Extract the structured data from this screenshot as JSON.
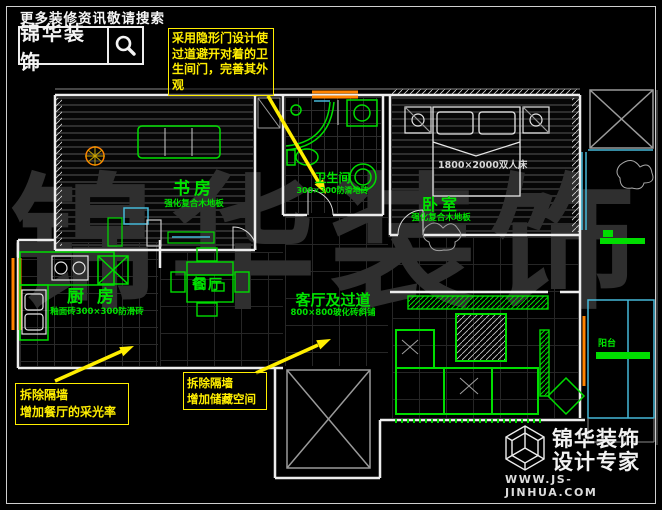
{
  "header": {
    "search_hint": "更多装修资讯敬请搜索",
    "brand": "锦华装饰",
    "search_icon": "magnifier-icon"
  },
  "callouts": {
    "hidden_door": {
      "text": "采用隐形门设计使过道避开对着的卫生间门，完善其外观"
    },
    "dining_light": {
      "line1": "拆除隔墙",
      "line2": "增加餐厅的采光率"
    },
    "storage": {
      "line1": "拆除隔墙",
      "line2": "增加储藏空间"
    }
  },
  "rooms": {
    "study": {
      "name": "书房",
      "floor": "强化复合木地板"
    },
    "bath": {
      "name": "卫生间",
      "floor": "300×300防滑地砖"
    },
    "bedroom": {
      "name": "卧室",
      "floor": "强化复合木地板"
    },
    "kitchen": {
      "name": "厨房",
      "floor": "釉面砖300×300防滑砖"
    },
    "dining": {
      "name": "餐厅"
    },
    "living": {
      "name": "客厅及过道",
      "floor": "800×800玻化砖斜铺"
    },
    "balcony": {
      "name": "阳台"
    }
  },
  "furniture": {
    "bed_label": "1800×2000双人床"
  },
  "watermark": {
    "text": "锦华装饰"
  },
  "footer": {
    "logo_icon": "cube-logo-icon",
    "brand_line1": "锦华装饰",
    "brand_line2": "设计专家",
    "website": "WWW.JS-JINHUA.COM"
  },
  "colors": {
    "cad_green": "#00dd00",
    "annotation_yellow": "#ffee00",
    "wall_white": "#ededed",
    "window_cyan": "#45b8d8",
    "window_orange": "#ff8400",
    "background": "#000000"
  }
}
